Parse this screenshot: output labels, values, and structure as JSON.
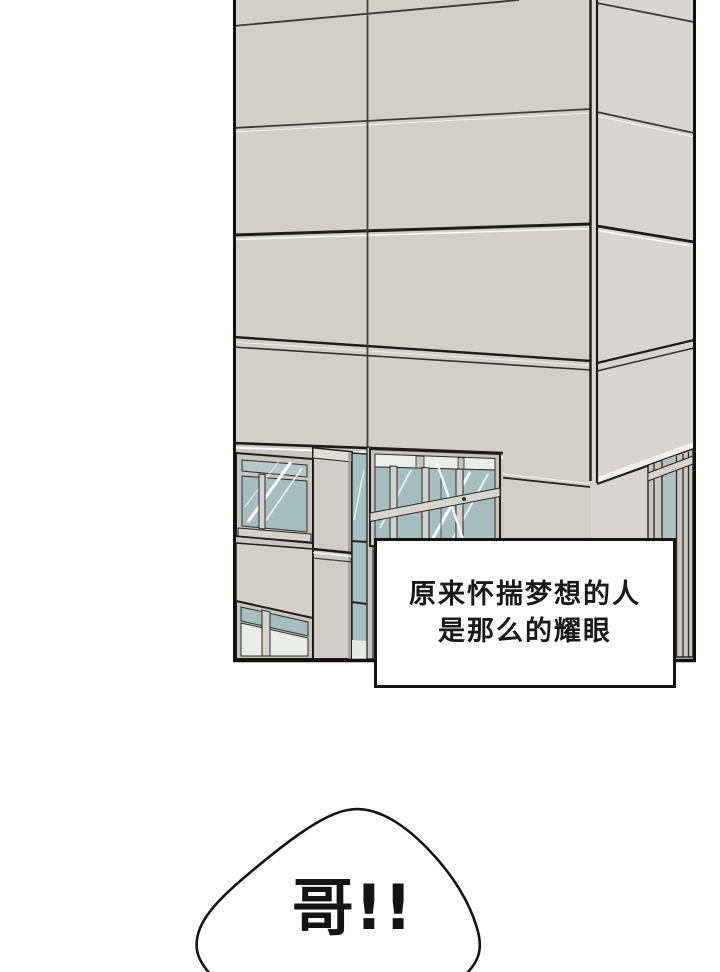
{
  "page": {
    "background_color": "#ffffff",
    "kind": "comic-panel-page"
  },
  "panel": {
    "caption_box": {
      "line1": "原来怀揣梦想的人",
      "line2": "是那么的耀眼"
    }
  },
  "speech_bubble": {
    "text": "哥!!"
  },
  "colors": {
    "panel_border": "#111111",
    "wall_front": "#d2cfc9",
    "wall_side": "#d7d5d1",
    "window_glass": "#a3bebd",
    "window_glass_light": "#e9ece9",
    "window_frame": "#c8c4bf",
    "caption_text": "#191919"
  }
}
